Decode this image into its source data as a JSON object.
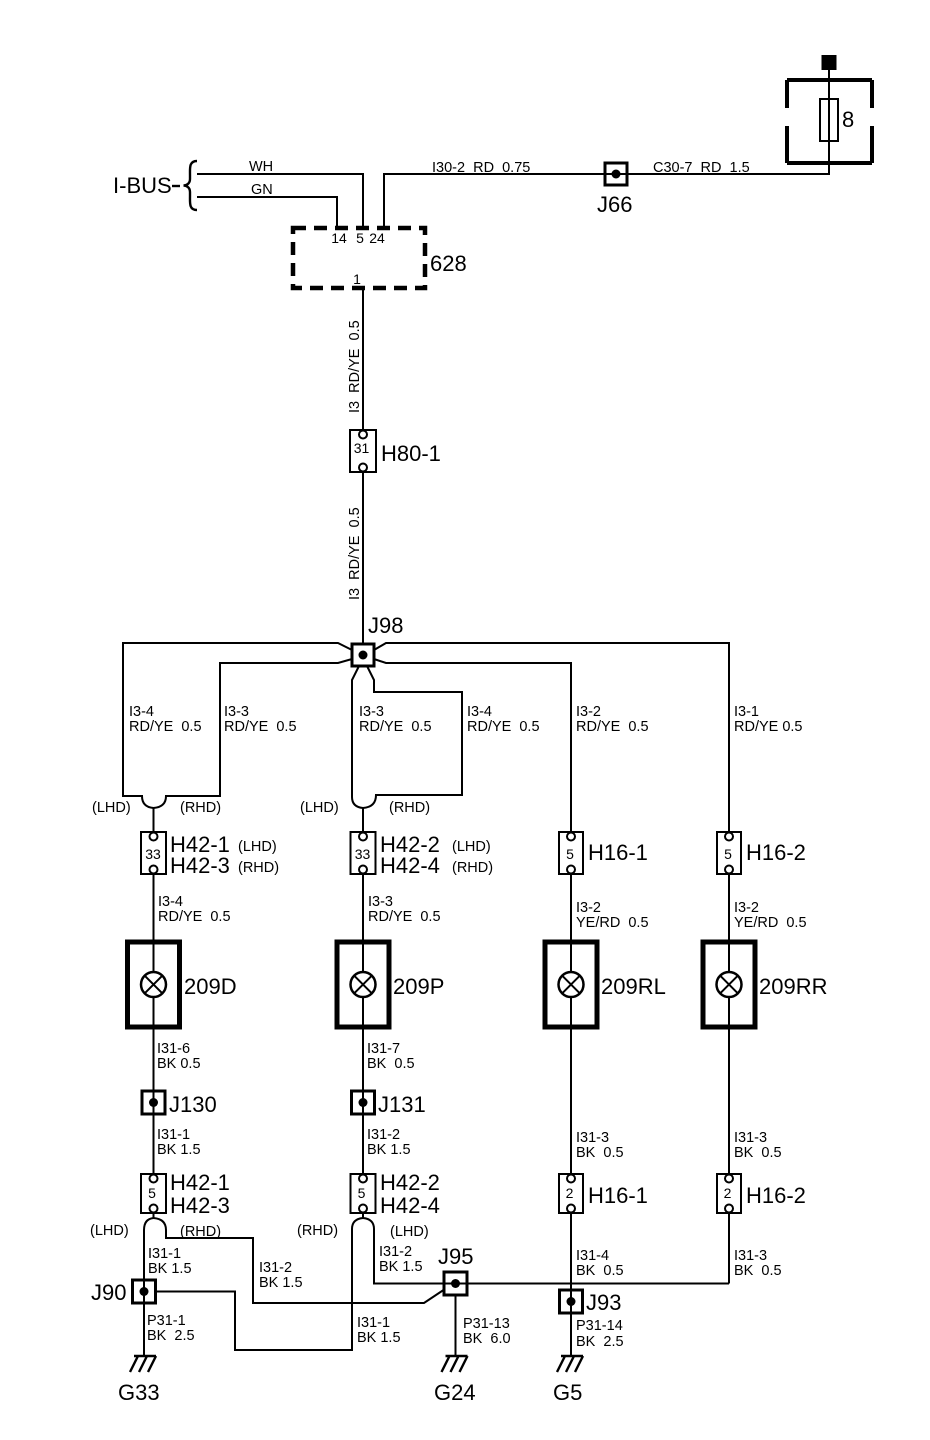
{
  "colors": {
    "ink": "#000000",
    "paper": "#ffffff"
  },
  "power": {
    "terminal": "+30",
    "fuse_number": "8",
    "wire_left": "I30-2  RD  0.75",
    "wire_right": "C30-7  RD  1.5",
    "junction": "J66"
  },
  "ibus": {
    "label": "I-BUS",
    "wire_top": "WH",
    "wire_bottom": "GN"
  },
  "module628": {
    "name": "628",
    "pin_left": "14",
    "pin_mid": "5",
    "pin_right": "24",
    "pin_bottom": "1"
  },
  "feed": {
    "wire_label": "I3  RD/YE  0.5",
    "h80_pin": "31",
    "h80_name": "H80-1",
    "junction": "J98"
  },
  "tags": {
    "lhd": "(LHD)",
    "rhd": "(RHD)"
  },
  "branch_labels": [
    {
      "id": "I3-4",
      "gauge": "RD/YE  0.5"
    },
    {
      "id": "I3-3",
      "gauge": "RD/YE  0.5"
    },
    {
      "id": "I3-3",
      "gauge": "RD/YE  0.5"
    },
    {
      "id": "I3-4",
      "gauge": "RD/YE  0.5"
    },
    {
      "id": "I3-2",
      "gauge": "RD/YE  0.5"
    },
    {
      "id": "I3-1",
      "gauge": "RD/YE 0.5"
    }
  ],
  "top_connectors": [
    {
      "pin": "33",
      "line1": "H42-1",
      "line2": "H42-3"
    },
    {
      "pin": "33",
      "line1": "H42-2",
      "line2": "H42-4"
    },
    {
      "pin": "5",
      "name": "H16-1"
    },
    {
      "pin": "5",
      "name": "H16-2"
    }
  ],
  "mid_wires": [
    {
      "id": "I3-4",
      "gauge": "RD/YE  0.5"
    },
    {
      "id": "I3-3",
      "gauge": "RD/YE  0.5"
    },
    {
      "id": "I3-2",
      "gauge": "YE/RD  0.5"
    },
    {
      "id": "I3-2",
      "gauge": "YE/RD  0.5"
    }
  ],
  "lamps": [
    "209D",
    "209P",
    "209RL",
    "209RR"
  ],
  "lamp_out_wires": [
    {
      "id": "I31-6",
      "gauge": "BK 0.5"
    },
    {
      "id": "I31-7",
      "gauge": "BK  0.5"
    },
    {
      "id": "I31-3",
      "gauge": "BK  0.5"
    },
    {
      "id": "I31-3",
      "gauge": "BK  0.5"
    }
  ],
  "mid_junctions": [
    "J130",
    "J131"
  ],
  "junction_out_wires": [
    {
      "id": "I31-1",
      "gauge": "BK 1.5"
    },
    {
      "id": "I31-2",
      "gauge": "BK 1.5"
    }
  ],
  "lower_connectors": [
    {
      "pin": "5",
      "line1": "H42-1",
      "line2": "H42-3"
    },
    {
      "pin": "5",
      "line1": "H42-2",
      "line2": "H42-4"
    },
    {
      "pin": "2",
      "name": "H16-1"
    },
    {
      "pin": "2",
      "name": "H16-2"
    }
  ],
  "bottom_wires": [
    {
      "id": "I31-1",
      "gauge": "BK 1.5"
    },
    {
      "id": "I31-2",
      "gauge": "BK 1.5"
    },
    {
      "id": "I31-2",
      "gauge": "BK 1.5"
    },
    {
      "id": "I31-1",
      "gauge": "BK 1.5"
    },
    {
      "id": "I31-4",
      "gauge": "BK  0.5"
    },
    {
      "id": "I31-3",
      "gauge": "BK  0.5"
    },
    {
      "id": "P31-1",
      "gauge": "BK  2.5"
    },
    {
      "id": "P31-13",
      "gauge": "BK  6.0"
    },
    {
      "id": "P31-14",
      "gauge": "BK  2.5"
    }
  ],
  "bottom_junctions": [
    "J90",
    "J95",
    "J93"
  ],
  "grounds": [
    "G33",
    "G24",
    "G5"
  ]
}
